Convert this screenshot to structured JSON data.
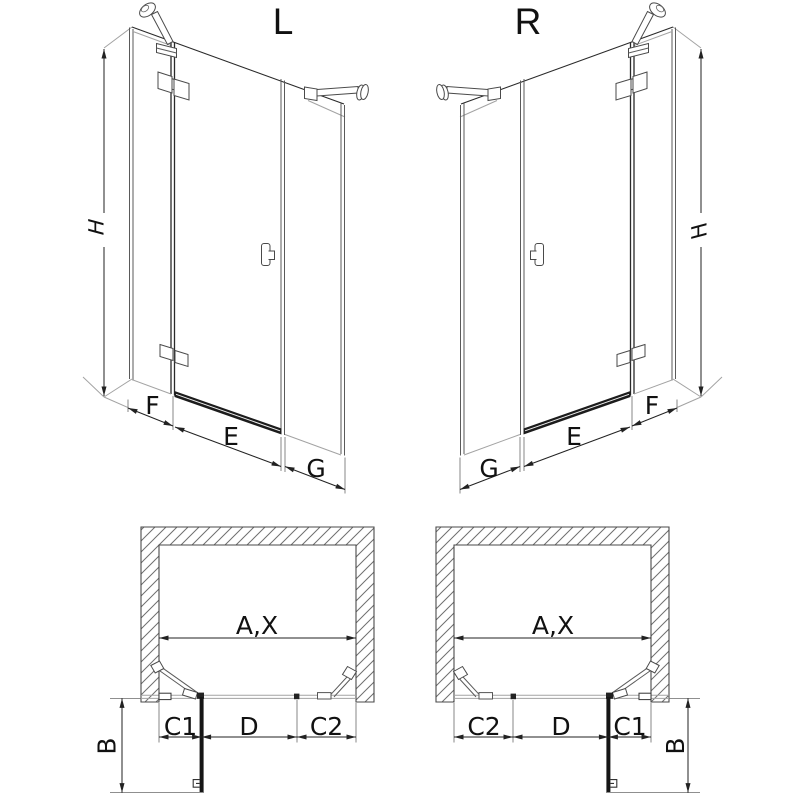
{
  "views": {
    "perspective_left": {
      "label": "L",
      "dim_height": "H",
      "dim_fixed_left": "F",
      "dim_door": "E",
      "dim_fixed_right": "G"
    },
    "perspective_right": {
      "label": "R",
      "dim_height": "H",
      "dim_fixed_left": "F",
      "dim_door": "E",
      "dim_fixed_right": "G"
    },
    "plan_left": {
      "dim_total_width": "A,X",
      "dim_c1": "C1",
      "dim_door": "D",
      "dim_c2": "C2",
      "dim_depth": "B"
    },
    "plan_right": {
      "dim_total_width": "A,X",
      "dim_c1": "C1",
      "dim_door": "D",
      "dim_c2": "C2",
      "dim_depth": "B"
    }
  },
  "colors": {
    "background": "#ffffff",
    "line_dark": "#2a2a2a",
    "line_medium": "#5a5a5a",
    "line_light": "#a3a3a3",
    "text": "#111111"
  }
}
